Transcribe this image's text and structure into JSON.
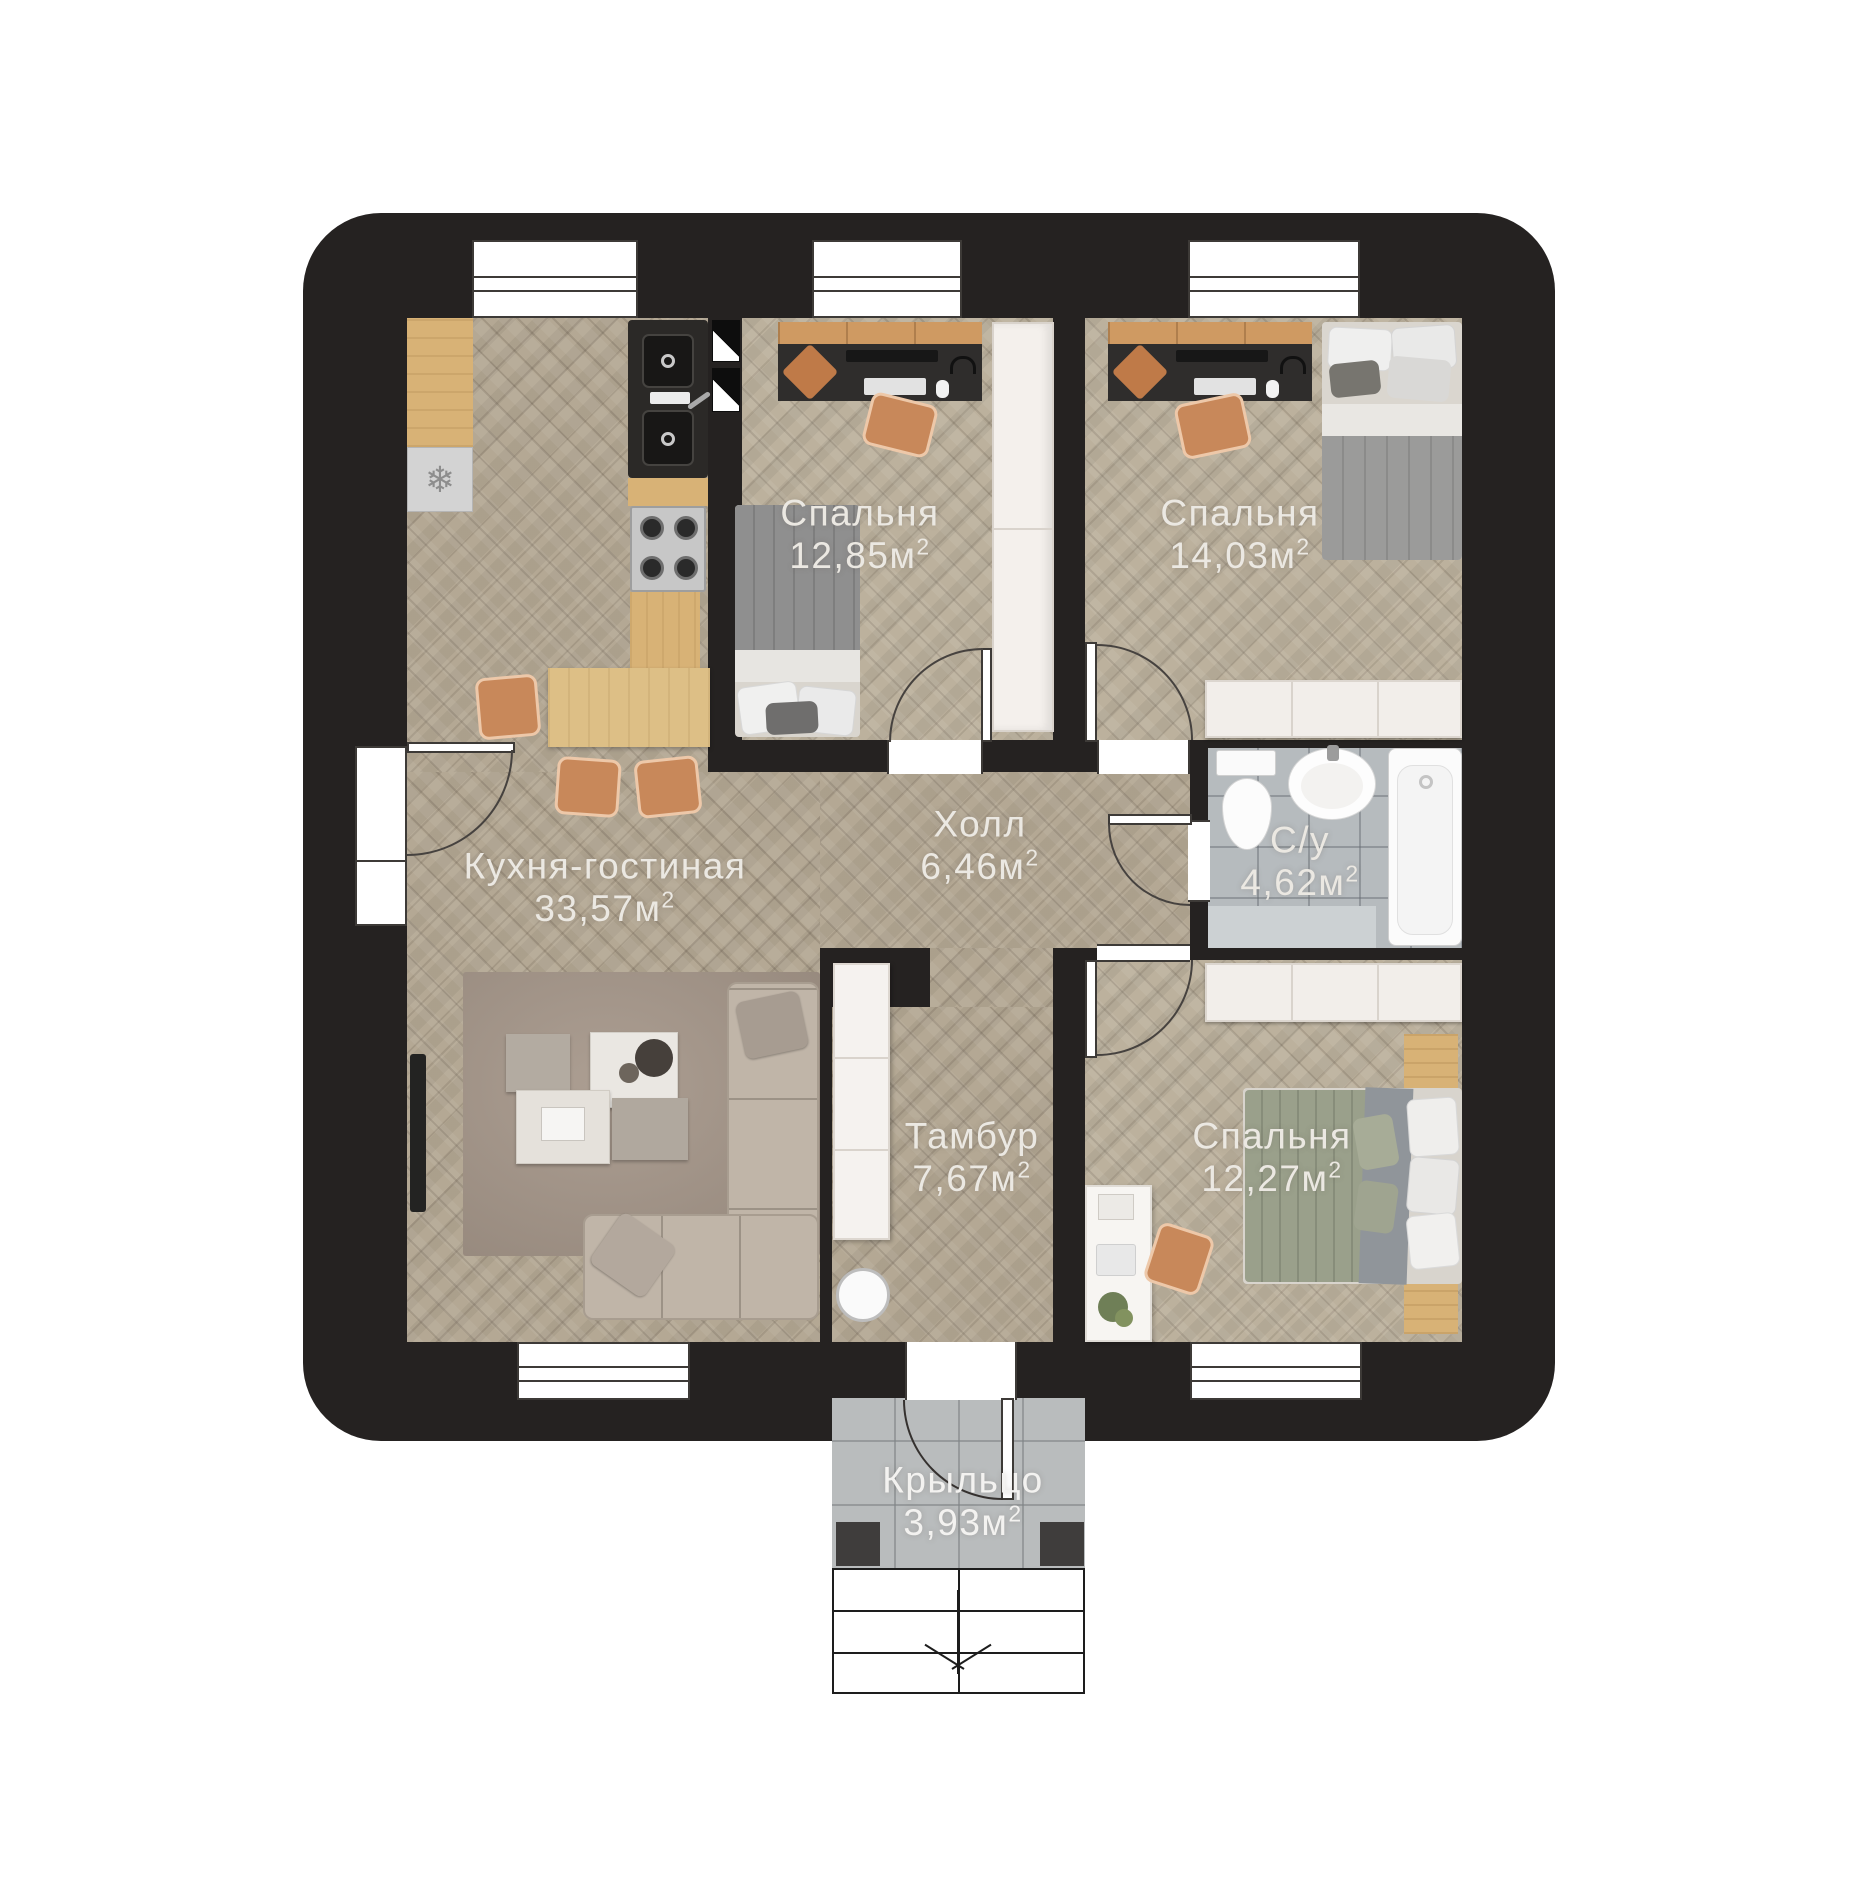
{
  "plan": {
    "rooms": [
      {
        "id": "kitchen-living",
        "name": "Кухня-гостиная",
        "area": "33,57",
        "unit": "м",
        "sup": "2"
      },
      {
        "id": "bedroom-1",
        "name": "Спальня",
        "area": "12,85",
        "unit": "м",
        "sup": "2"
      },
      {
        "id": "bedroom-2",
        "name": "Спальня",
        "area": "14,03",
        "unit": "м",
        "sup": "2"
      },
      {
        "id": "hall",
        "name": "Холл",
        "area": "6,46",
        "unit": "м",
        "sup": "2"
      },
      {
        "id": "bathroom",
        "name": "С/у",
        "area": "4,62",
        "unit": "м",
        "sup": "2"
      },
      {
        "id": "vestibule",
        "name": "Тамбур",
        "area": "7,67",
        "unit": "м",
        "sup": "2"
      },
      {
        "id": "bedroom-3",
        "name": "Спальня",
        "area": "12,27",
        "unit": "м",
        "sup": "2"
      },
      {
        "id": "porch",
        "name": "Крыльцо",
        "area": "3,93",
        "unit": "м",
        "sup": "2"
      }
    ],
    "icons": {
      "freezer": "❄"
    },
    "colors": {
      "wall": "#252221",
      "wood_floor": "#b4a894",
      "bedroom_floor": "#bcb19d",
      "tile_floor": "#b6bbbe",
      "porch_floor": "#b9bcbd",
      "kitchen_wood": "#d8b276",
      "chair_orange": "#c8885a",
      "label_text": "#ebe8e2"
    }
  }
}
